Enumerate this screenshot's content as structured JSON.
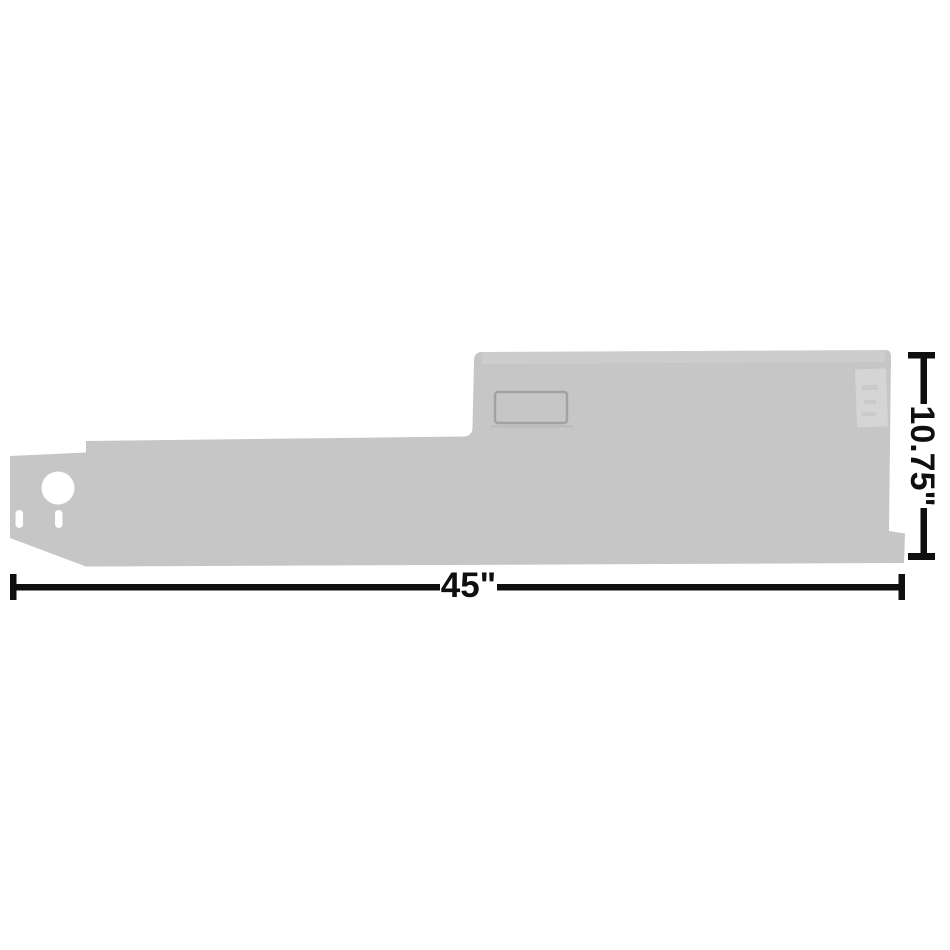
{
  "page": {
    "background": "#ffffff",
    "description": "Gray replacement panel part shown with width and height dimension callouts"
  },
  "part": {
    "fill": "#c6c6c6",
    "hole_fill": "#ffffff",
    "recess_stroke": "#a2a2a2",
    "recess_shadow": "#b9b9b9",
    "sticker_fill": "#d5d5d5",
    "sticker_mark": "#c3c3c3"
  },
  "dimensions": {
    "color": "#0f0f0f",
    "width_label": "45\"",
    "height_label": "10.75\""
  }
}
